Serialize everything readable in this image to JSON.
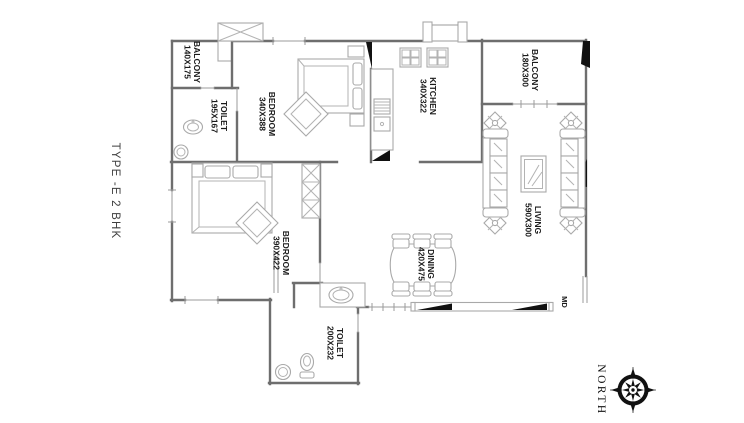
{
  "title": "TYPE -E 2 BHK",
  "north_label": "NORTH",
  "main_door_label": "MD",
  "rooms": [
    {
      "name": "BALCONY",
      "dims": "140X175"
    },
    {
      "name": "TOILET",
      "dims": "195X167"
    },
    {
      "name": "BEDROOM",
      "dims": "340X388"
    },
    {
      "name": "KITCHEN",
      "dims": "340X322"
    },
    {
      "name": "BALCONY",
      "dims": "180X300"
    },
    {
      "name": "LIVING",
      "dims": "590X300"
    },
    {
      "name": "DINING",
      "dims": "420X475"
    },
    {
      "name": "BEDROOM",
      "dims": "390X422"
    },
    {
      "name": "TOILET",
      "dims": "200X232"
    }
  ],
  "colors": {
    "background": "#ffffff",
    "wall": "#6e6e6e",
    "furniture": "#a9a9a9",
    "door_leaf": "#111111",
    "label_text": "#1a1a1a"
  },
  "icons": [
    "compass-rose-icon",
    "bed-icon",
    "wardrobe-icon",
    "sofa-icon",
    "coffee-table-icon",
    "dining-table-icon",
    "chair-icon",
    "plant-icon",
    "sink-icon",
    "wc-icon",
    "stove-icon",
    "door-leaf-icon",
    "shaft-icon",
    "duct-icon"
  ]
}
